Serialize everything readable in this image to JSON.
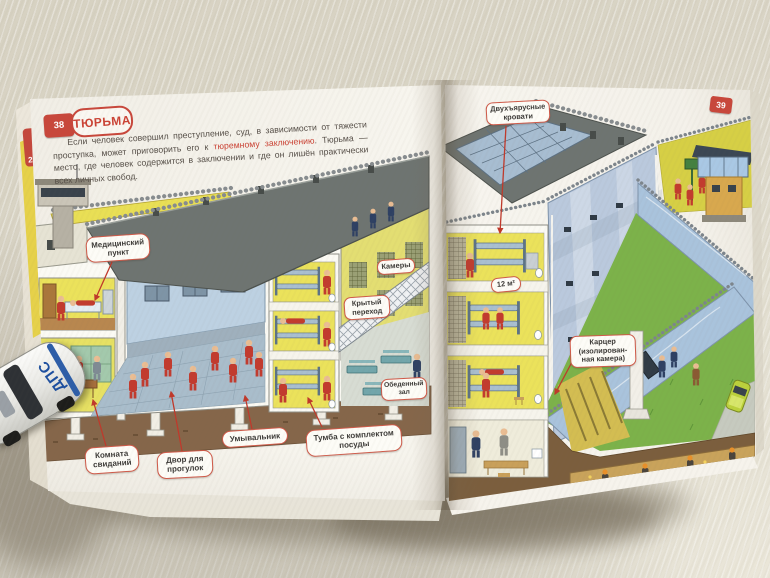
{
  "book": {
    "left_page": {
      "tab_number": "38",
      "under_tab_number": "2",
      "title": "ТЮРЬМА",
      "intro_before": "Если человек совершил преступление, суд, в зависимости от тяжести проступка, может приговорить его к ",
      "intro_highlight": "тюремному заключению",
      "intro_after": ". Тюрьма — место, где человек содержится в заключении и где он лишён практически всех личных свобод.",
      "labels": {
        "medical": "Медицинский пункт",
        "visiting": "Комната свиданий",
        "yard": "Двор для прогулок",
        "washbasin": "Умывальник",
        "nightstand": "Тумба с комплектом посуды",
        "cells": "Камеры",
        "walkway": "Крытый переход",
        "dining": "Обеденный зал"
      }
    },
    "right_page": {
      "tab_number": "39",
      "labels": {
        "bunk_beds": "Двухъярусные кровати",
        "cell_area": "12 м²",
        "solitary_line1": "Карцер",
        "solitary_line2": "(изолирован-",
        "solitary_line3": "ная камера)"
      }
    }
  },
  "toy_car": {
    "marking": "ДПС"
  },
  "colors": {
    "accent_red": "#c8473b",
    "label_border": "#d05a49",
    "table_surface": "#d9d4c6",
    "page_paper": "#f7f5ee",
    "roof_gray": "#6e7471",
    "wall_yellow": "#ebe25b",
    "wall_blue": "#bac9dd",
    "grass_green": "#7cb24a",
    "soil_brown": "#85664a",
    "prisoner_uniform_red": "#c23b2e",
    "guard_uniform_navy": "#2e4063"
  }
}
